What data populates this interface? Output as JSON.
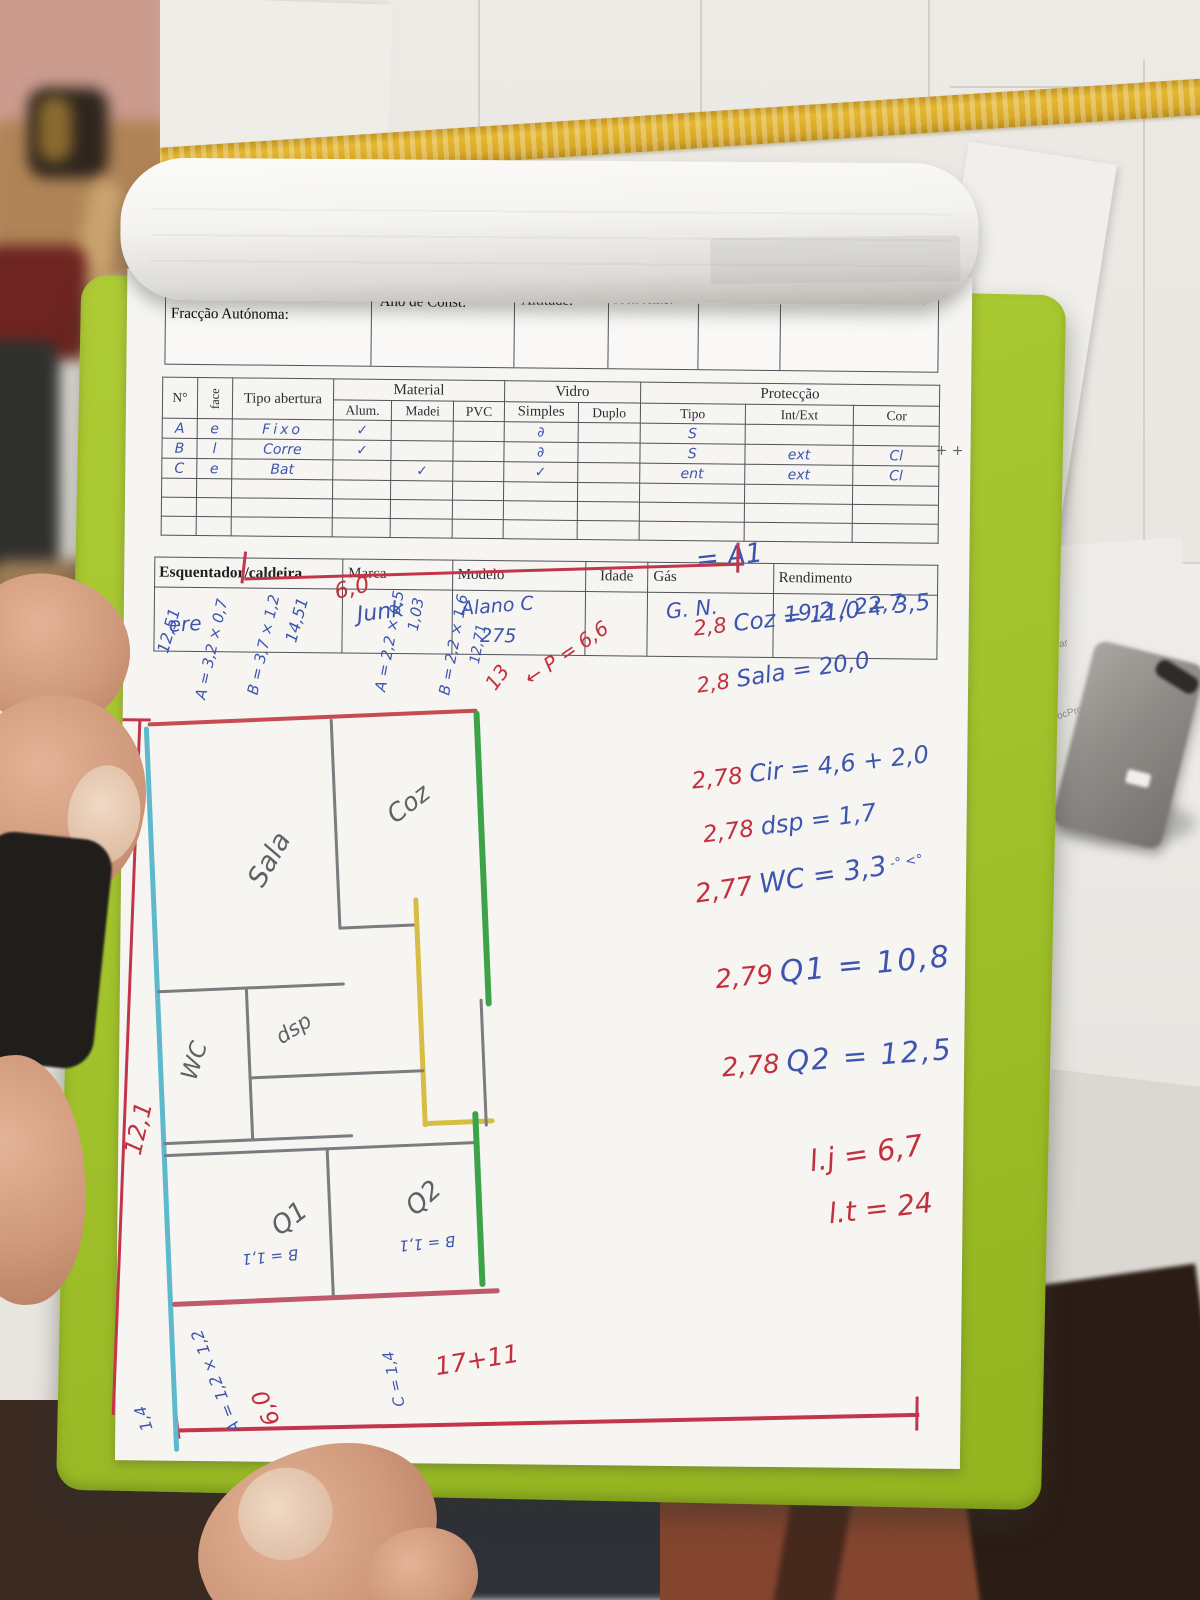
{
  "scene": {
    "side_sheet": {
      "numbers": "9 9 50",
      "line1": "ambos guardar",
      "line2": "MobileDocPropCert v.5"
    }
  },
  "form": {
    "owner_scribble": "Rua da Qta. O——",
    "header_fields": [
      "Fracção Autónoma:",
      "Ano de Const:",
      "Altitude:",
      "Pré.Frente?",
      "Elevador",
      "Pavimento e Cobertura"
    ],
    "openings_table": {
      "fixed_headers": {
        "num": "N°",
        "face": "face",
        "tipo": "Tipo abertura"
      },
      "group_headers": {
        "material": "Material",
        "vidro": "Vidro",
        "proteccao": "Protecção"
      },
      "sub_headers": [
        "Alum.",
        "Madei",
        "PVC",
        "Simples",
        "Duplo",
        "Tipo",
        "Int/Ext",
        "Cor"
      ],
      "rows": [
        {
          "num": "A",
          "face": "e",
          "tipo": "Fixo",
          "alum": "✓",
          "madei": "",
          "pvc": "",
          "simples": "∂",
          "duplo": "",
          "prot_tipo": "S",
          "int_ext": "",
          "cor": ""
        },
        {
          "num": "B",
          "face": "l",
          "tipo": "Corre",
          "alum": "✓",
          "madei": "",
          "pvc": "",
          "simples": "∂",
          "duplo": "",
          "prot_tipo": "S",
          "int_ext": "ext",
          "cor": "Cl"
        },
        {
          "num": "C",
          "face": "e",
          "tipo": "Bat",
          "alum": "",
          "madei": "✓",
          "pvc": "",
          "simples": "✓",
          "duplo": "",
          "prot_tipo": "ent",
          "int_ext": "ext",
          "cor": "Cl"
        }
      ],
      "margin_mark": "+ +"
    },
    "heater_table": {
      "headers": [
        "Esquentador/caldeira",
        "Marca",
        "Modelo",
        "Idade",
        "Gás",
        "Rendimento"
      ],
      "values": {
        "esq": "ere",
        "marca": "Junk",
        "modelo": "Alano C",
        "modelo2": "275",
        "idade": "",
        "gas": "G. N.",
        "rendimento": "19,2 / 22,7"
      }
    }
  },
  "notes": {
    "a1": "= A1",
    "calcs": [
      {
        "h": "2,8",
        "t": "Coz = 11,0 + 3,5",
        "suffix": ""
      },
      {
        "h": "2,8",
        "t": "Sala = 20,0",
        "suffix": ""
      },
      {
        "h": "2,78",
        "t": "Cir = 4,6 + 2,0",
        "suffix": ""
      },
      {
        "h": "2,78",
        "t": "dsp = 1,7",
        "suffix": ""
      },
      {
        "h": "2,77",
        "t": "WC = 3,3",
        "suffix": "-°  <°"
      },
      {
        "h": "2,79",
        "t": "Q1 = 10,8",
        "suffix": ""
      },
      {
        "h": "2,78",
        "t": "Q2 = 12,5",
        "suffix": ""
      }
    ],
    "totals": [
      "l.j = 6,7",
      "l.t = 24"
    ]
  },
  "plan": {
    "rooms": [
      "Sala",
      "Coz",
      "WC",
      "dsp",
      "Q1",
      "Q2"
    ],
    "dims_top": [
      "12,51",
      "A = 3,2 × 0,7",
      "B = 3,7 × 1,2",
      "14,51",
      "6,0",
      "A = 2,2 × 0,5",
      "1,03",
      "B = 2,2 × 1,6",
      "12,71",
      "13",
      "← P = 6,6"
    ],
    "dim_left": "12,1",
    "dims_bottom": [
      "B = 1,1",
      "B = 1,1",
      "C = 1,4",
      "A = 1,2 × 1,2",
      "1,4",
      "17+11",
      "6,0"
    ]
  },
  "colors": {
    "clipboard_green": "#a2c32c",
    "ink_blue": "#3d55ae",
    "ink_red": "#c2303e",
    "wall_cyan": "#5fb9cd",
    "wall_green": "#3da349",
    "wall_yellow": "#d7bd45",
    "tile_border_yellow": "#dcab2c"
  }
}
